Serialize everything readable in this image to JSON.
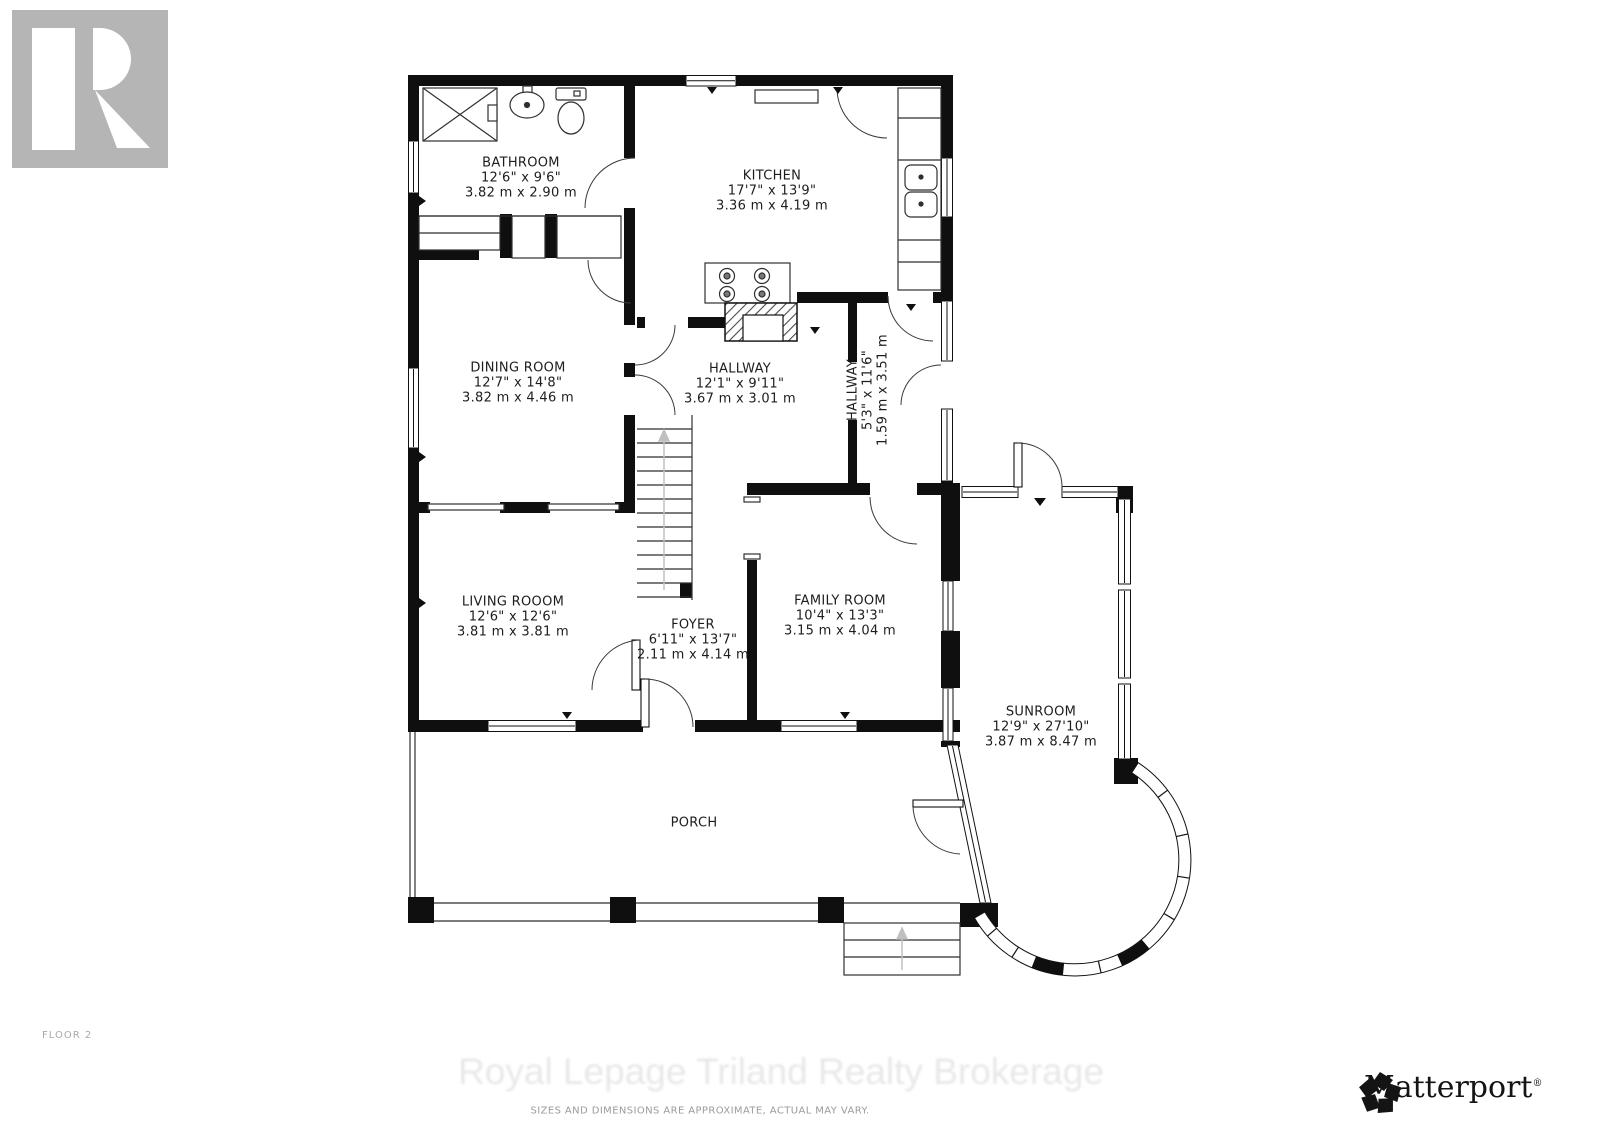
{
  "floor_label": "FLOOR 2",
  "watermark": "Royal Lepage Triland Realty Brokerage",
  "disclaimer": "SIZES AND DIMENSIONS ARE APPROXIMATE, ACTUAL MAY VARY.",
  "branding": {
    "realtor_logo_text": "REALTOR",
    "realtor_reg_mark": "®",
    "matterport_text": "Matterport",
    "matterport_reg_mark": "®"
  },
  "colors": {
    "walls": "#0f0f0f",
    "thin_lines": "#2f2f2f",
    "logo_gray": "#b5b5b5",
    "watermark_gray": "#e8e8e8",
    "disclaimer_gray": "#9b9b9b",
    "label_text": "#1d1d1d"
  },
  "rooms": [
    {
      "id": "bathroom",
      "name": "BATHROOM",
      "imperial": "12'6\" x 9'6\"",
      "metric": "3.82 m x 2.90 m"
    },
    {
      "id": "kitchen",
      "name": "KITCHEN",
      "imperial": "17'7\" x 13'9\"",
      "metric": "3.36 m x 4.19 m"
    },
    {
      "id": "dining-room",
      "name": "DINING ROOM",
      "imperial": "12'7\" x 14'8\"",
      "metric": "3.82 m x 4.46 m"
    },
    {
      "id": "hallway",
      "name": "HALLWAY",
      "imperial": "12'1\" x 9'11\"",
      "metric": "3.67 m x 3.01 m"
    },
    {
      "id": "hallway-side",
      "name": "HALLWAY",
      "imperial": "5'3\" x 11'6\"",
      "metric": "1.59 m x 3.51 m"
    },
    {
      "id": "living-room",
      "name": "LIVING ROOOM",
      "imperial": "12'6\" x 12'6\"",
      "metric": "3.81 m x 3.81 m"
    },
    {
      "id": "foyer",
      "name": "FOYER",
      "imperial": "6'11\" x 13'7\"",
      "metric": "2.11 m x 4.14 m"
    },
    {
      "id": "family-room",
      "name": "FAMILY ROOM",
      "imperial": "10'4\" x 13'3\"",
      "metric": "3.15 m x 4.04 m"
    },
    {
      "id": "sunroom",
      "name": "SUNROOM",
      "imperial": "12'9\" x 27'10\"",
      "metric": "3.87 m x 8.47 m"
    },
    {
      "id": "porch",
      "name": "PORCH",
      "imperial": "",
      "metric": ""
    }
  ]
}
